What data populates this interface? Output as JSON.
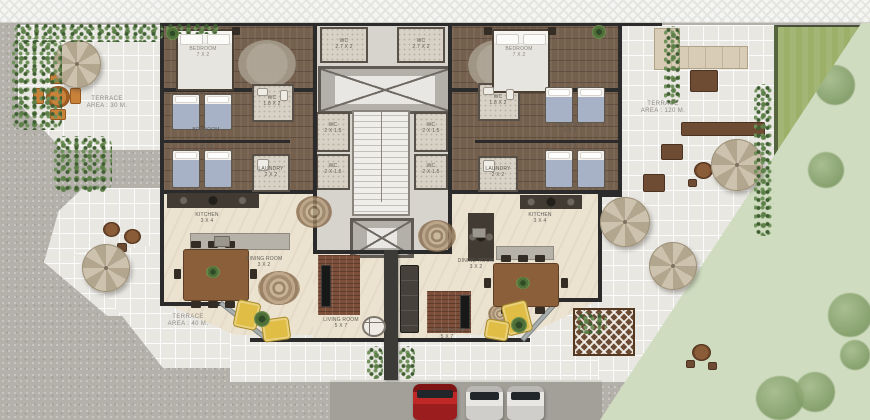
{
  "scene": {
    "type": "residential floor plan",
    "view": "top-down site plan"
  },
  "palette": {
    "wall": "#2b2b2b",
    "wood": "#75604e",
    "cream": "#ebe2d0",
    "tile": "#e8e7e2",
    "sidewalk": "#b4b1ab",
    "road": "#a3a099",
    "lawn": "#9cb06a",
    "garden": "#cfdcc0",
    "brick": "#7d4f3a",
    "yellow": "#e0bd45",
    "bed": "#a7b2c6",
    "car_red": "#c02828",
    "car_white": "#e8e7e4",
    "umbrella": "#c9bda9"
  },
  "rooms": {
    "master": {
      "name": "BEDROOM",
      "dims": "7 X 2"
    },
    "twin": {
      "name": "BEDROOM",
      "dims": "4 X 3"
    },
    "wc_top": {
      "name": "WC",
      "dims": "2.7 X 2"
    },
    "wc_core": {
      "name": "WC",
      "dims": "2 X 1.5"
    },
    "wc_apt": {
      "name": "WC",
      "dims": "1.8 X 2"
    },
    "laundry": {
      "name": "LAUNDRY",
      "dims": "2 X 2"
    },
    "kitchen": {
      "name": "KITCHEN",
      "dims": "3 X 4"
    },
    "dining": {
      "name": "DINING ROOM",
      "dims": "3 X 2"
    },
    "living": {
      "name": "LIVING ROOM",
      "dims": "5 X 7"
    }
  },
  "terraces": {
    "left_top": {
      "name": "TERRACE",
      "dims": "AREA : 30 M."
    },
    "left_bottom": {
      "name": "TERRACE",
      "dims": "AREA : 40 M."
    },
    "right": {
      "name": "TERRACE",
      "dims": "AREA : 120 M."
    }
  }
}
